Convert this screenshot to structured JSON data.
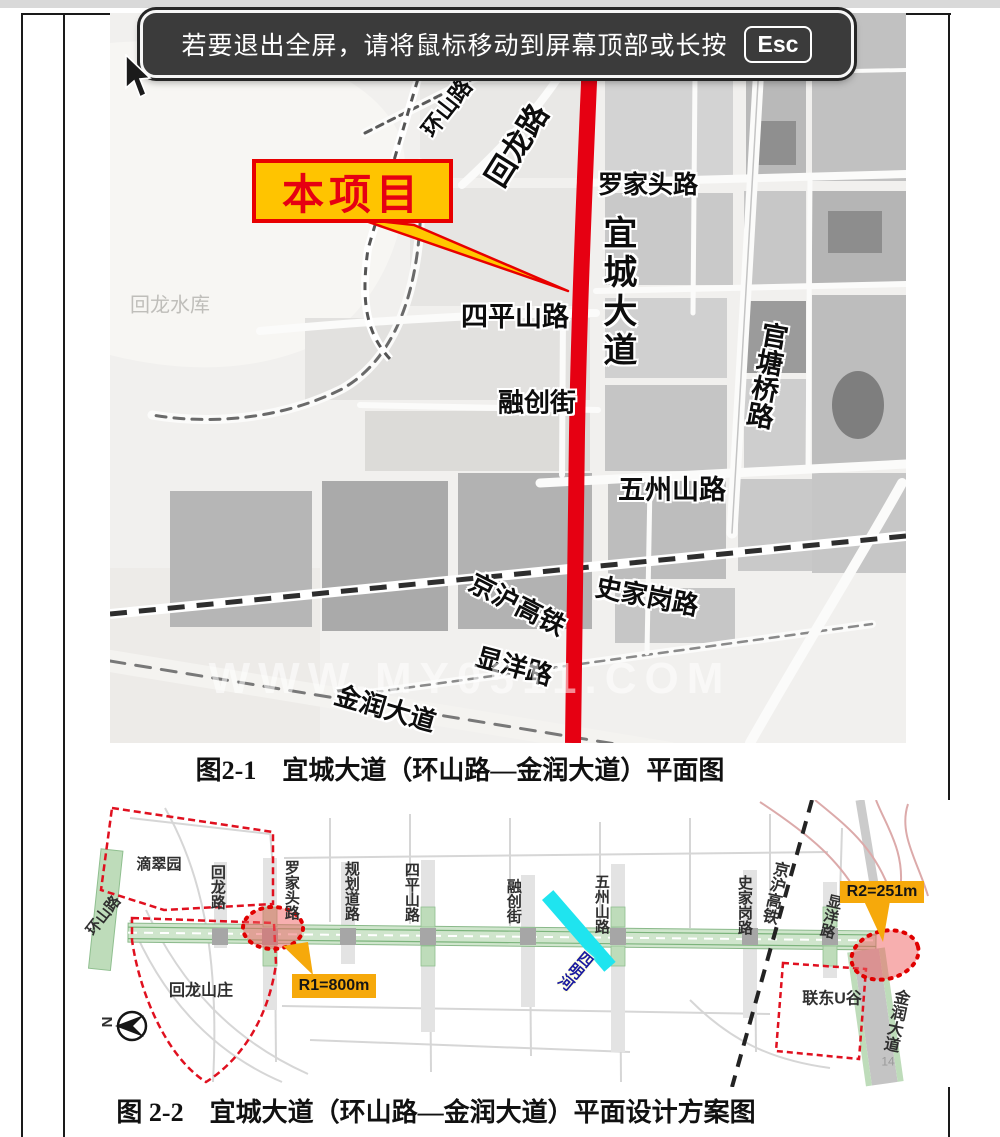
{
  "notification": {
    "text": "若要退出全屏，请将鼠标移动到屏幕顶部或长按",
    "esc_key": "Esc"
  },
  "figure1": {
    "callout": "本项目",
    "watermark": "WWW.MY0511.COM",
    "labels": {
      "huanshan_road": "环山路",
      "huilong_road": "回龙路",
      "luojiatou_road": "罗家头路",
      "yicheng_avenue": "宜城大道",
      "guantangqiao_road": "官塘桥路",
      "huilong_reservoir": "回龙水库",
      "sipingshan_road": "四平山路",
      "rongchuang_street": "融创街",
      "wuzhoushan_road": "五州山路",
      "jinghu_railway": "京沪高铁",
      "shijiagang_road": "史家岗路",
      "xianyang_road": "显洋路",
      "jinrun_avenue": "金润大道"
    },
    "caption": "图2-1　宜城大道（环山路—金润大道）平面图"
  },
  "figure2": {
    "labels": {
      "dicuiyuan_garden": "滴翠园",
      "huilong_road": "回龙路",
      "huanshan_road": "环山路",
      "luojiatou_road": "罗家头路",
      "planned_road": "规划道路",
      "sipingshan_road": "四平山路",
      "rongchuang_street": "融创街",
      "wuzhoushan_road": "五州山路",
      "siming_river": "四明河",
      "shijiagang_road": "史家岗路",
      "jinghu_railway": "京沪高铁",
      "xianyang_road": "显洋路",
      "huilong_villa": "回龙山庄",
      "liandong_u_valley": "联东U谷",
      "jinrun_avenue": "金润大道"
    },
    "annotations": {
      "r1": "R1=800m",
      "r2": "R2=251m"
    },
    "north": "N",
    "page_number": "14",
    "caption": "图 2-2　宜城大道（环山路—金润大道）平面设计方案图"
  },
  "colors": {
    "highlight_road": "#e60012",
    "callout_bg": "#ffc400",
    "annotation_bg": "#f6a90b",
    "river": "#1fe4ef",
    "blue_label": "#1c2db0",
    "green_road": "#cfe5cc"
  }
}
